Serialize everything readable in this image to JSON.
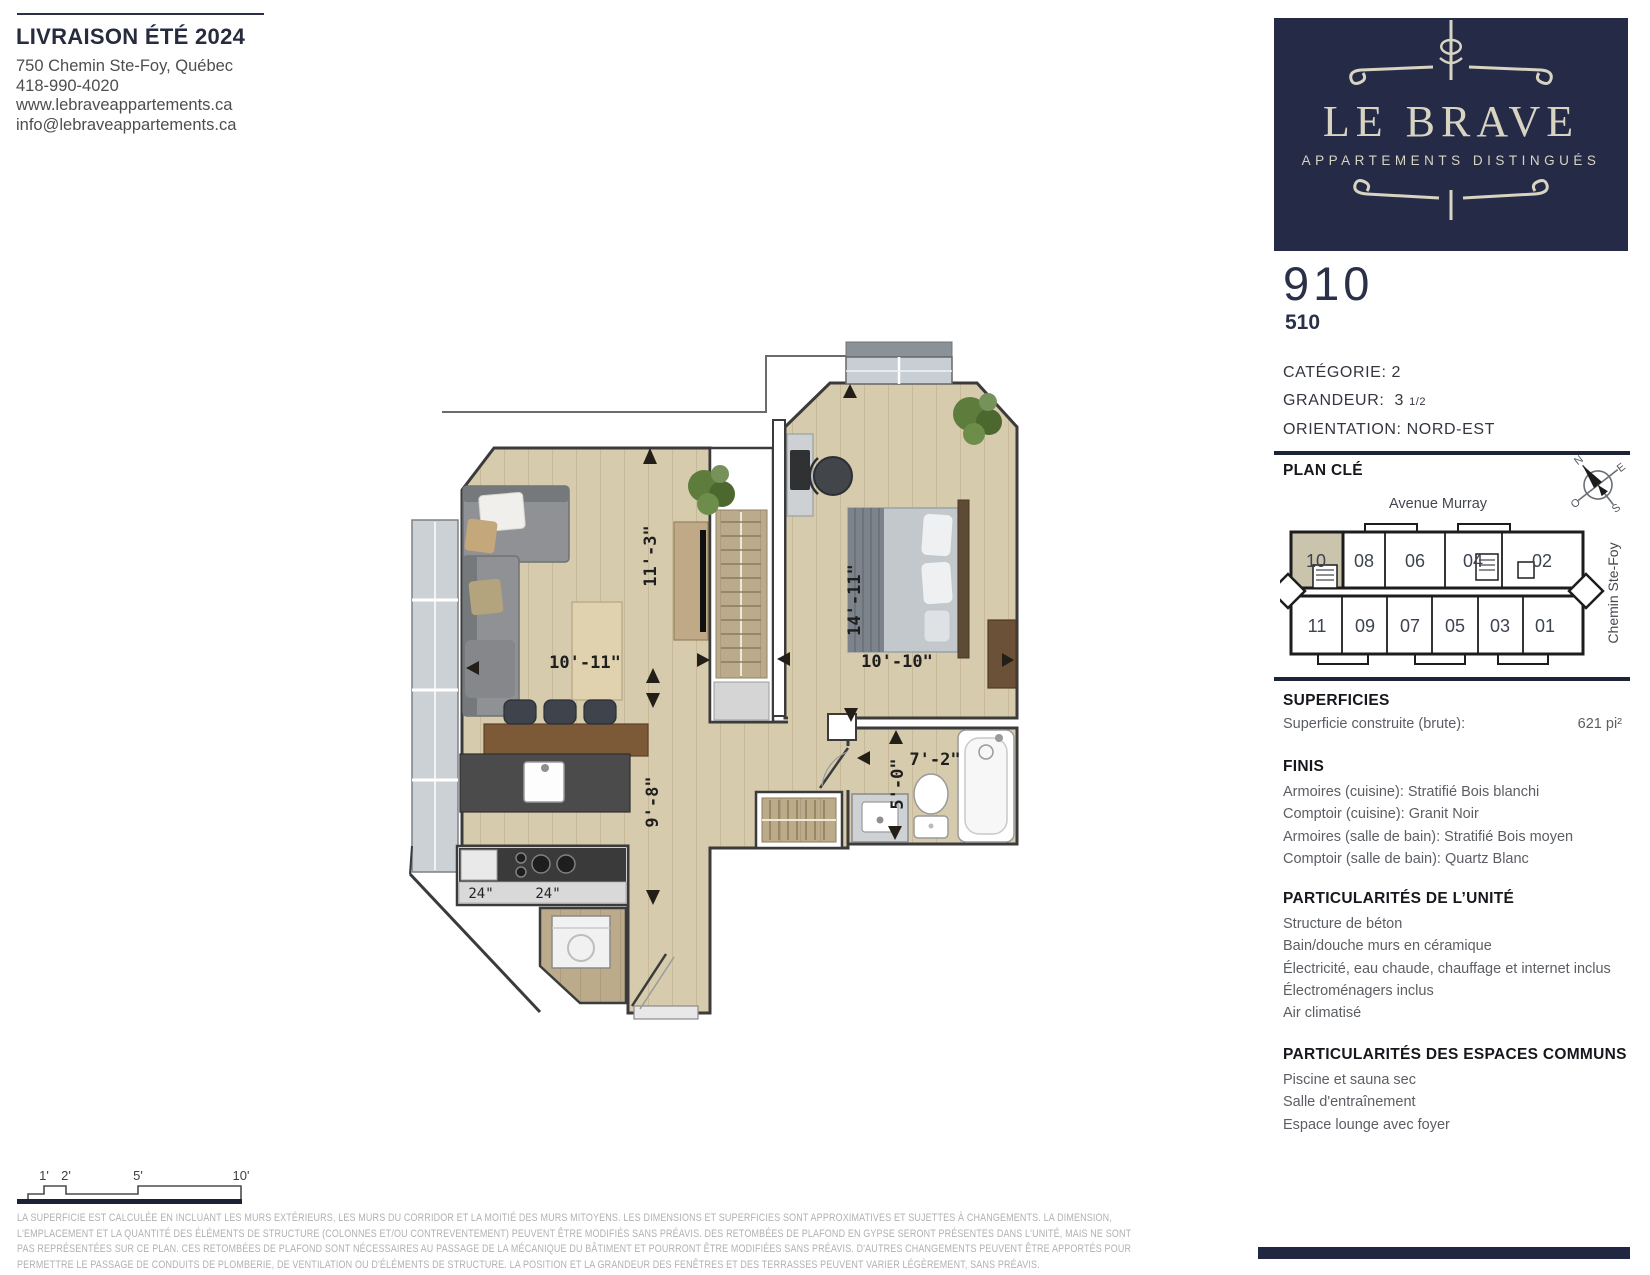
{
  "brand": {
    "delivery": "LIVRAISON ÉTÉ 2024",
    "address": "750 Chemin Ste-Foy, Québec",
    "phone": "418-990-4020",
    "website": "www.lebraveappartements.ca",
    "email": "info@lebraveappartements.ca",
    "logo_name": "LE BRAVE",
    "logo_tagline": "APPARTEMENTS DISTINGUÉS"
  },
  "unit": {
    "number": "910",
    "alt_number": "510",
    "category_label": "CATÉGORIE:",
    "category_value": "2",
    "size_label": "GRANDEUR:",
    "size_value": "3",
    "size_fraction": "1/2",
    "orientation_label": "ORIENTATION:",
    "orientation_value": "NORD-EST"
  },
  "key_plan": {
    "heading": "PLAN CLÉ",
    "street_top": "Avenue Murray",
    "street_right": "Chemin Ste-Foy",
    "compass": {
      "n": "N",
      "e": "E",
      "o": "O",
      "s": "S"
    },
    "top_units": [
      "10",
      "08",
      "06",
      "04",
      "02"
    ],
    "bottom_units": [
      "11",
      "09",
      "07",
      "05",
      "03",
      "01"
    ],
    "highlighted_unit": "10",
    "highlight_color": "#cbc4ad"
  },
  "superficies": {
    "heading": "SUPERFICIES",
    "label": "Superficie construite (brute):",
    "value": "621 pi²"
  },
  "finis": {
    "heading": "FINIS",
    "items": [
      "Armoires (cuisine): Stratifié Bois blanchi",
      "Comptoir (cuisine): Granit Noir",
      "Armoires (salle de bain): Stratifié Bois moyen",
      "Comptoir (salle de bain): Quartz Blanc"
    ]
  },
  "unit_features": {
    "heading": "PARTICULARITÉS DE L’UNITÉ",
    "items": [
      "Structure de béton",
      "Bain/douche murs en céramique",
      "Électricité, eau chaude, chauffage et internet inclus",
      "Électroménagers inclus",
      "Air climatisé"
    ]
  },
  "common_features": {
    "heading": "PARTICULARITÉS DES ESPACES COMMUNS",
    "items": [
      "Piscine et sauna sec",
      "Salle d'entraînement",
      "Espace lounge avec foyer"
    ]
  },
  "floor_plan": {
    "dimensions": {
      "living_width": "10'-11\"",
      "living_height": "11'-3\"",
      "bedroom_width": "10'-10\"",
      "bedroom_height": "14'-11\"",
      "kitchen_height": "9'-8\"",
      "bathroom_width": "7'-2\"",
      "bathroom_height": "5'-0\"",
      "counter_left": "24\"",
      "counter_right": "24\""
    }
  },
  "scale_bar": {
    "labels": [
      "1'",
      "2'",
      "5'",
      "10'"
    ]
  },
  "disclaimer": {
    "lines": [
      "LA SUPERFICIE EST CALCULÉE EN INCLUANT LES MURS EXTÉRIEURS, LES MURS DU CORRIDOR ET LA MOITIÉ DES MURS MITOYENS. LES DIMENSIONS ET SUPERFICIES SONT APPROXIMATIVES ET SUJETTES À CHANGEMENTS. LA DIMENSION,",
      "L'EMPLACEMENT ET LA QUANTITÉ DES ÉLÉMENTS DE STRUCTURE (COLONNES ET/OU CONTREVENTEMENT) PEUVENT ÊTRE MODIFIÉS SANS PRÉAVIS. DES RETOMBÉES DE PLAFOND EN GYPSE SERONT PRÉSENTES DANS L'UNITÉ, MAIS NE SONT",
      "PAS REPRÉSENTÉES SUR CE PLAN. CES RETOMBÉES DE PLAFOND SONT NÉCESSAIRES AU PASSAGE DE LA MÉCANIQUE DU BÂTIMENT ET POURRONT ÊTRE MODIFIÉES SANS PRÉAVIS. D'AUTRES CHANGEMENTS PEUVENT ÊTRE APPORTÉS POUR",
      "PERMETTRE LE PASSAGE DE CONDUITS DE PLOMBERIE, DE VENTILATION OU D'ÉLÉMENTS DE STRUCTURE. LA POSITION ET LA GRANDEUR DES FENÊTRES ET DES TERRASSES PEUVENT VARIER LÉGÈREMENT, SANS PRÉAVIS."
    ]
  }
}
